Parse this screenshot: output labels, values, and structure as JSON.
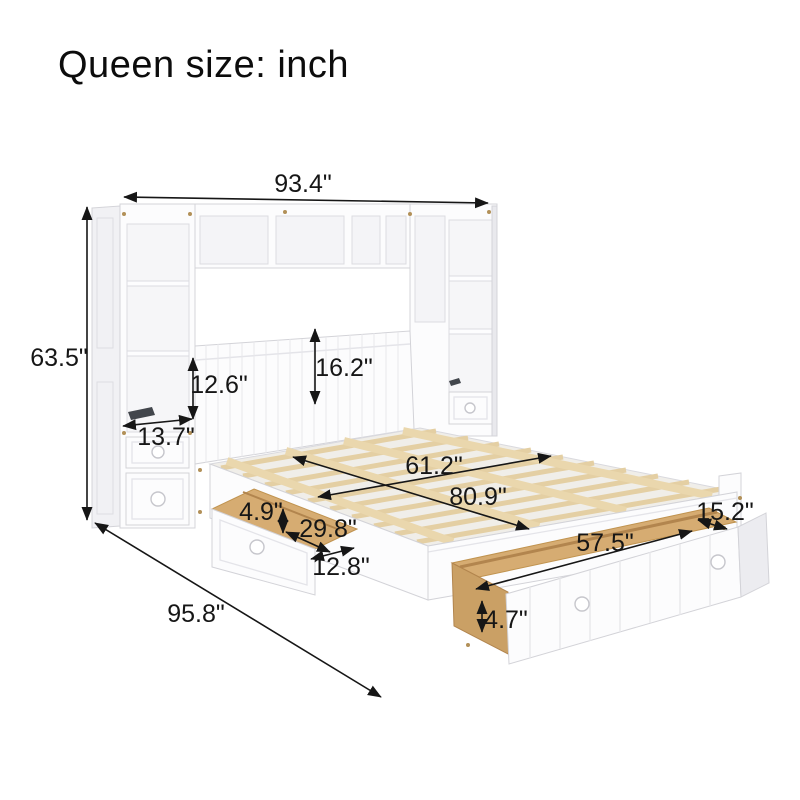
{
  "title": "Queen size: inch",
  "unit": "inch",
  "colors": {
    "background": "#ffffff",
    "furniture_white": "#fcfcfd",
    "outline_gray": "#d4d4d9",
    "slat_wood": "#e4cfa3",
    "drawer_wood": "#d6ac72",
    "annotation_black": "#161616",
    "slot_dark": "#42464c"
  },
  "dimensions": [
    {
      "id": "overall-width",
      "value": "93.4\""
    },
    {
      "id": "overall-height",
      "value": "63.5\""
    },
    {
      "id": "headboard-opening-height",
      "value": "12.6\""
    },
    {
      "id": "headboard-panel-height",
      "value": "16.2\""
    },
    {
      "id": "shelf-depth",
      "value": "13.7\""
    },
    {
      "id": "bed-width",
      "value": "61.2\""
    },
    {
      "id": "bed-length",
      "value": "80.9\""
    },
    {
      "id": "side-drawer-height",
      "value": "4.9\""
    },
    {
      "id": "side-drawer-length",
      "value": "29.8\""
    },
    {
      "id": "side-drawer-width",
      "value": "12.8\""
    },
    {
      "id": "trundle-width",
      "value": "57.5\""
    },
    {
      "id": "trundle-extension",
      "value": "15.2\""
    },
    {
      "id": "trundle-depth",
      "value": "4.7\""
    },
    {
      "id": "overall-depth",
      "value": "95.8\""
    }
  ]
}
